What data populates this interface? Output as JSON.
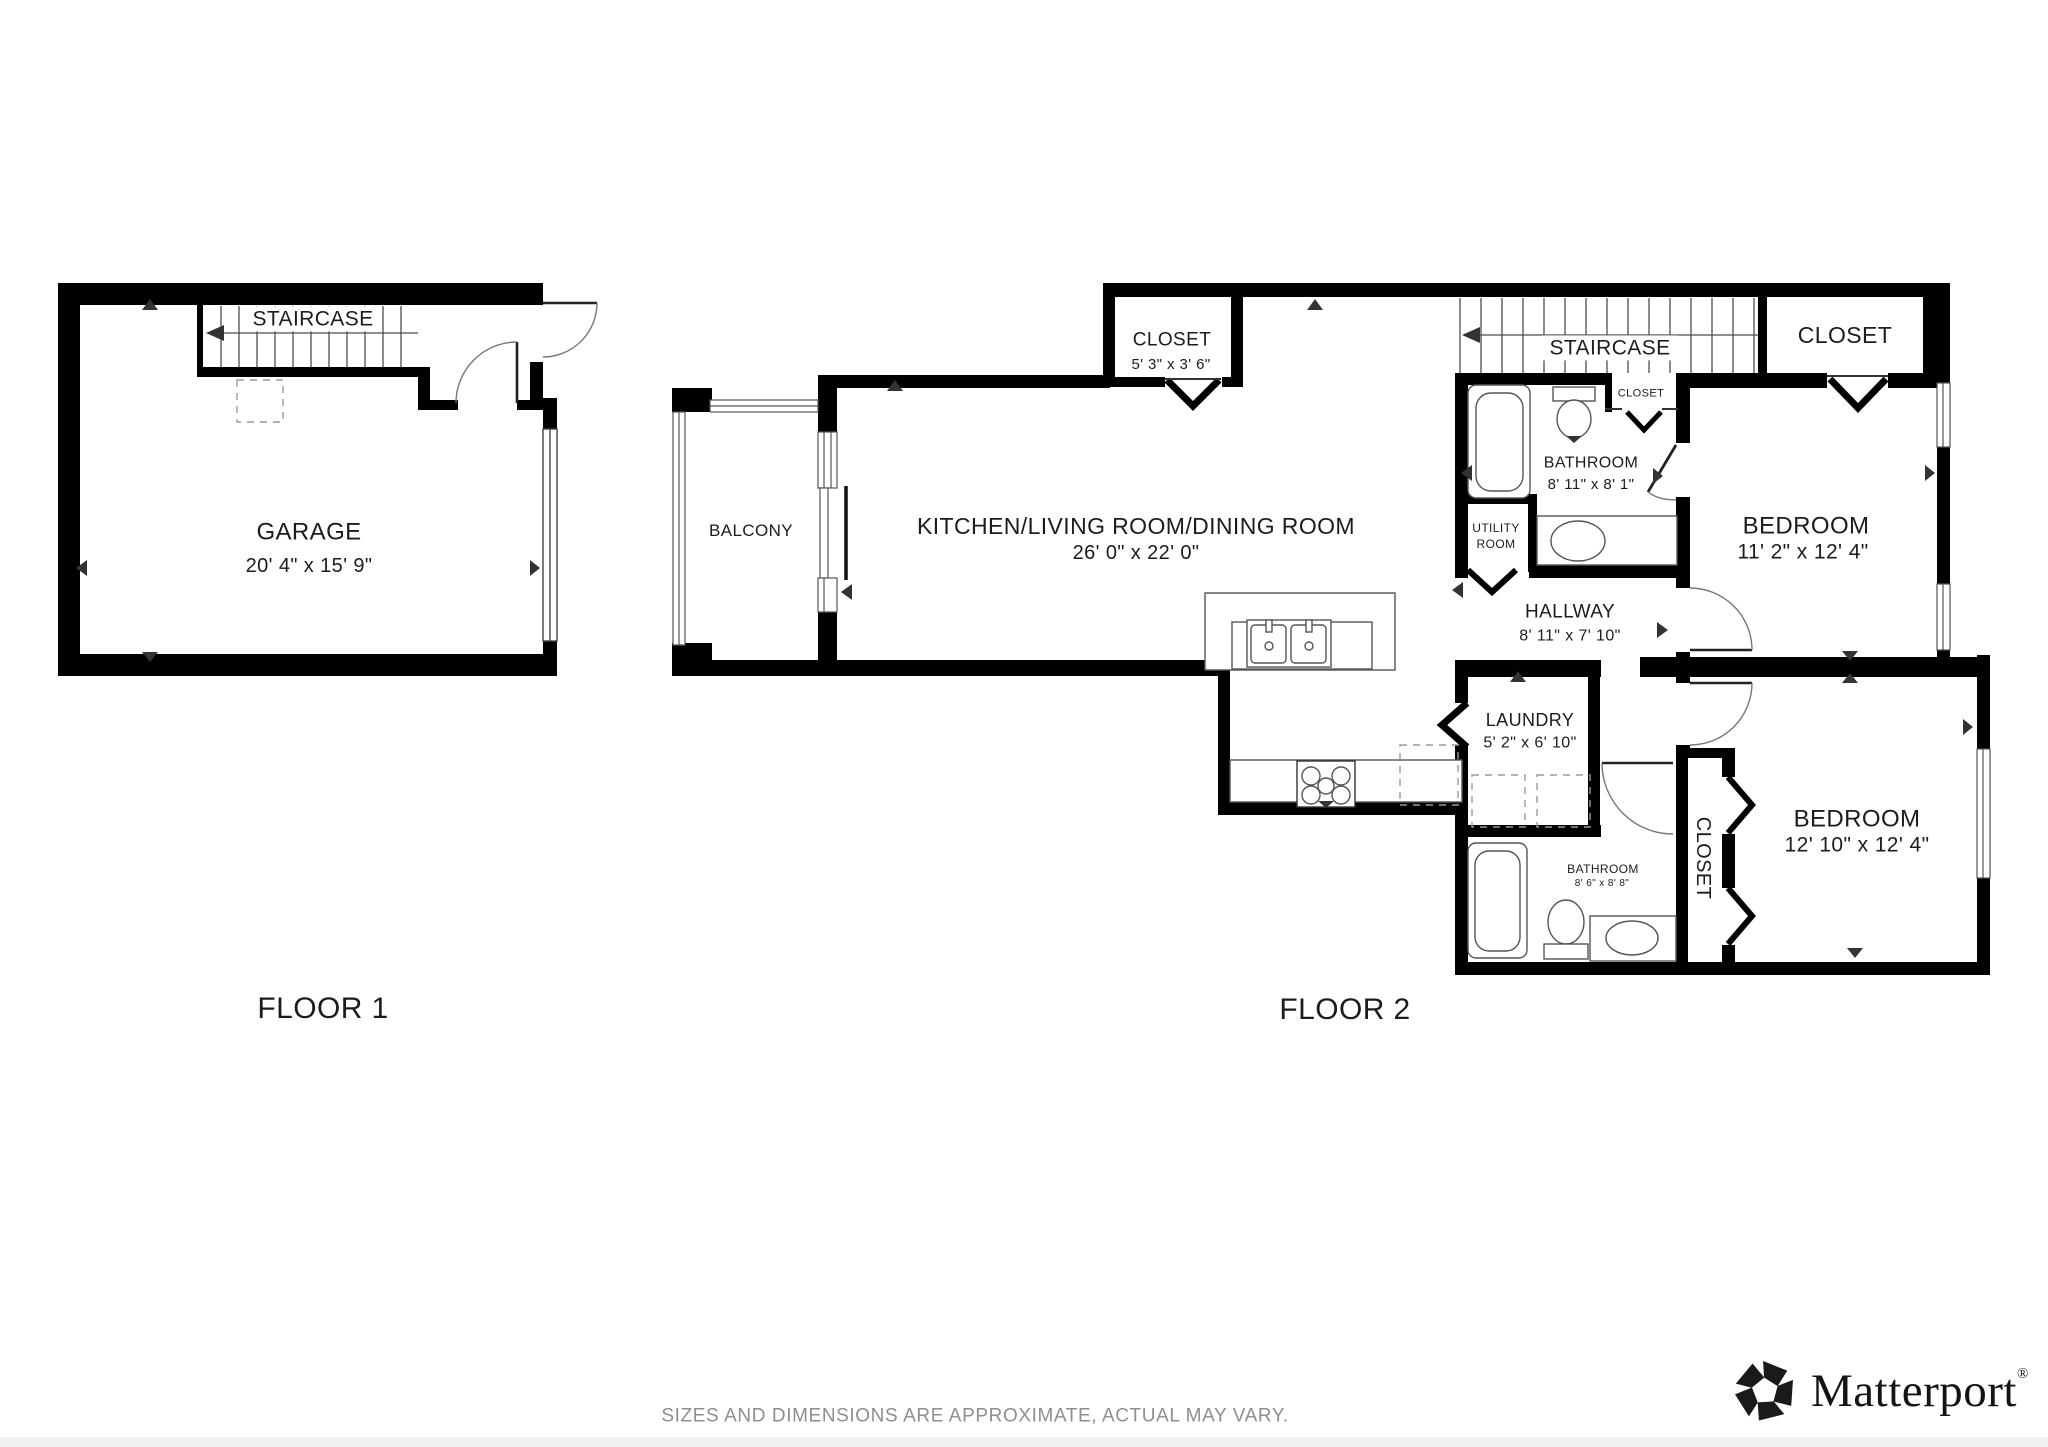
{
  "floors": {
    "floor1_label": "FLOOR 1",
    "floor2_label": "FLOOR 2"
  },
  "rooms": {
    "garage": {
      "name": "GARAGE",
      "dims": "20' 4\" x 15' 9\""
    },
    "staircase1": {
      "name": "STAIRCASE"
    },
    "balcony": {
      "name": "BALCONY"
    },
    "kitchen": {
      "name": "KITCHEN/LIVING ROOM/DINING ROOM",
      "dims": "26' 0\" x 22' 0\""
    },
    "closet_top": {
      "name": "CLOSET",
      "dims": "5' 3\" x 3' 6\""
    },
    "staircase2": {
      "name": "STAIRCASE"
    },
    "closet_tr": {
      "name": "CLOSET"
    },
    "closet_small": {
      "name": "CLOSET"
    },
    "bathroom1": {
      "name": "BATHROOM",
      "dims": "8' 11\" x 8' 1\""
    },
    "utility": {
      "name": "UTILITY ROOM"
    },
    "bedroom1": {
      "name": "BEDROOM",
      "dims": "11' 2\" x 12' 4\""
    },
    "hallway": {
      "name": "HALLWAY",
      "dims": "8' 11\" x 7' 10\""
    },
    "laundry": {
      "name": "LAUNDRY",
      "dims": "5' 2\" x 6' 10\""
    },
    "bathroom2": {
      "name": "BATHROOM",
      "dims": "8' 6\" x 8' 8\""
    },
    "closet_vert": {
      "name": "CLOSET"
    },
    "bedroom2": {
      "name": "BEDROOM",
      "dims": "12' 10\" x 12' 4\""
    }
  },
  "footer": {
    "disclaimer": "SIZES AND DIMENSIONS ARE APPROXIMATE, ACTUAL MAY VARY."
  },
  "branding": {
    "logo_text": "Matterport",
    "registered_mark": "®",
    "logo_icon": "matterport-pinwheel-icon"
  },
  "colors": {
    "wall": "#000000",
    "thin_line": "#4d4d4d",
    "footer_text": "#8e8e8e"
  }
}
